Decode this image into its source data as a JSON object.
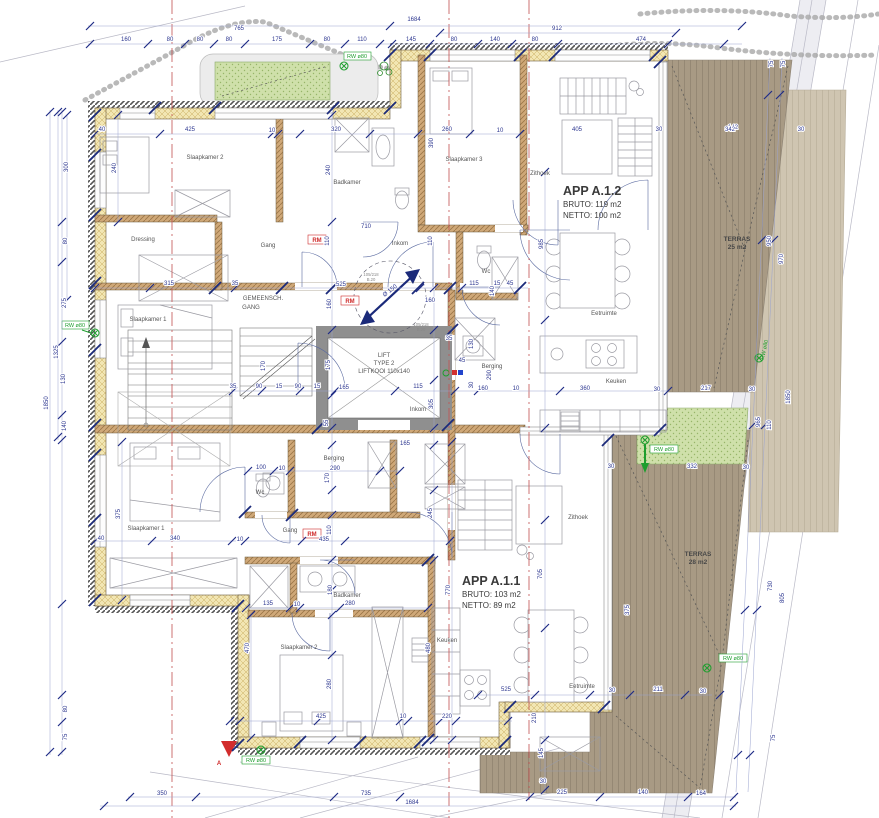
{
  "colors": {
    "dimension_text": "#2d3790",
    "wall_exterior": "#f2e6b3",
    "wall_interior": "#cfa878",
    "terrace_deck": "#a89a84",
    "terrace_light": "#cfc5b1",
    "green_roof": "#cfe0aa",
    "red_mark": "#cf2b2b",
    "green_mark": "#1e9e2e",
    "reference_line": "#c25050"
  },
  "labels": {
    "apartments": [
      {
        "t": "APP A.1.2",
        "x": 563,
        "y": 195,
        "c": "app",
        "a": "start"
      },
      {
        "t": "BRUTO: 119 m2",
        "x": 563,
        "y": 207,
        "c": "appsub",
        "a": "start"
      },
      {
        "t": "NETTO: 100 m2",
        "x": 563,
        "y": 218,
        "c": "appsub",
        "a": "start"
      },
      {
        "t": "APP A.1.1",
        "x": 462,
        "y": 585,
        "c": "app",
        "a": "start"
      },
      {
        "t": "BRUTO: 103 m2",
        "x": 462,
        "y": 597,
        "c": "appsub",
        "a": "start"
      },
      {
        "t": "NETTO: 89 m2",
        "x": 462,
        "y": 608,
        "c": "appsub",
        "a": "start"
      }
    ],
    "terraces": [
      {
        "t": "TERRAS",
        "x": 737,
        "y": 241,
        "c": "ter"
      },
      {
        "t": "25 m2",
        "x": 737,
        "y": 249,
        "c": "ter"
      },
      {
        "t": "TERRAS",
        "x": 698,
        "y": 556,
        "c": "ter"
      },
      {
        "t": "28 m2",
        "x": 698,
        "y": 564,
        "c": "ter"
      }
    ],
    "rooms": [
      {
        "t": "Slaapkamer 2",
        "x": 205,
        "y": 159,
        "c": "room"
      },
      {
        "t": "Badkamer",
        "x": 347,
        "y": 184,
        "c": "room"
      },
      {
        "t": "Slaapkamer 3",
        "x": 464,
        "y": 161,
        "c": "room"
      },
      {
        "t": "Dressing",
        "x": 143,
        "y": 241,
        "c": "room"
      },
      {
        "t": "Gang",
        "x": 268,
        "y": 247,
        "c": "room"
      },
      {
        "t": "Inkom",
        "x": 400,
        "y": 245,
        "c": "room"
      },
      {
        "t": "Zithoek",
        "x": 540,
        "y": 175,
        "c": "room"
      },
      {
        "t": "Slaapkamer 1",
        "x": 148,
        "y": 321,
        "c": "room"
      },
      {
        "t": "GEMEENSCH.",
        "x": 263,
        "y": 300,
        "c": "room"
      },
      {
        "t": "GANG",
        "x": 251,
        "y": 309,
        "c": "room"
      },
      {
        "t": "Wc",
        "x": 486,
        "y": 273,
        "c": "room"
      },
      {
        "t": "Berging",
        "x": 492,
        "y": 368,
        "c": "room"
      },
      {
        "t": "Eetruimte",
        "x": 604,
        "y": 315,
        "c": "room"
      },
      {
        "t": "Keuken",
        "x": 616,
        "y": 383,
        "c": "room"
      },
      {
        "t": "Berging",
        "x": 334,
        "y": 460,
        "c": "room"
      },
      {
        "t": "Wc",
        "x": 260,
        "y": 494,
        "c": "room"
      },
      {
        "t": "Slaapkamer 1",
        "x": 146,
        "y": 530,
        "c": "room"
      },
      {
        "t": "Gang",
        "x": 290,
        "y": 532,
        "c": "room"
      },
      {
        "t": "Inkom",
        "x": 418,
        "y": 411,
        "c": "room"
      },
      {
        "t": "Badkamer",
        "x": 347,
        "y": 597,
        "c": "room"
      },
      {
        "t": "Slaapkamer 2",
        "x": 299,
        "y": 649,
        "c": "room"
      },
      {
        "t": "Keuken",
        "x": 447,
        "y": 642,
        "c": "room"
      },
      {
        "t": "Zithoek",
        "x": 578,
        "y": 519,
        "c": "room"
      },
      {
        "t": "Eetruimte",
        "x": 582,
        "y": 688,
        "c": "room"
      }
    ],
    "lift": [
      {
        "t": "LIFT",
        "x": 384,
        "y": 357,
        "c": "lift"
      },
      {
        "t": "TYPE 2",
        "x": 384,
        "y": 365,
        "c": "lift"
      },
      {
        "t": "LIFTKOOI 110x140",
        "x": 384,
        "y": 373,
        "c": "lift"
      }
    ],
    "red_marks": [
      {
        "t": "RM",
        "x": 317,
        "y": 242,
        "c": "red"
      },
      {
        "t": "RM",
        "x": 350,
        "y": 303,
        "c": "red"
      },
      {
        "t": "RM",
        "x": 312,
        "y": 536,
        "c": "red"
      },
      {
        "t": "A",
        "x": 219,
        "y": 765,
        "c": "red"
      }
    ],
    "green_marks": [
      {
        "t": "RW ø80",
        "x": 357,
        "y": 58,
        "c": "grn"
      },
      {
        "t": "RW ø80",
        "x": 75,
        "y": 327,
        "c": "grn"
      },
      {
        "t": "RW ø80",
        "x": 766,
        "y": 350,
        "c": "grn",
        "r": -78
      },
      {
        "t": "RW ø80",
        "x": 664,
        "y": 451,
        "c": "grn"
      },
      {
        "t": "RW ø80",
        "x": 733,
        "y": 660,
        "c": "grn"
      },
      {
        "t": "RW ø80",
        "x": 256,
        "y": 762,
        "c": "grn"
      }
    ],
    "annotations": [
      {
        "t": "105/218",
        "x": 371,
        "y": 276,
        "c": "tiny"
      },
      {
        "t": "B.20",
        "x": 371,
        "y": 281,
        "c": "tiny"
      },
      {
        "t": "105/218",
        "x": 421,
        "y": 326,
        "c": "tiny"
      },
      {
        "t": "B.20",
        "x": 421,
        "y": 331,
        "c": "tiny"
      },
      {
        "t": "Ø 150",
        "x": 391,
        "y": 292,
        "c": "circ",
        "r": -38
      }
    ],
    "dimensions": [
      {
        "t": "765",
        "x": 239,
        "y": 30,
        "c": "dim"
      },
      {
        "t": "1684",
        "x": 414,
        "y": 21,
        "c": "dim"
      },
      {
        "t": "912",
        "x": 557,
        "y": 30,
        "c": "dim"
      },
      {
        "t": "160",
        "x": 126,
        "y": 41,
        "c": "dim"
      },
      {
        "t": "80",
        "x": 170,
        "y": 41,
        "c": "dim"
      },
      {
        "t": "80",
        "x": 200,
        "y": 41,
        "c": "dim"
      },
      {
        "t": "80",
        "x": 229,
        "y": 41,
        "c": "dim"
      },
      {
        "t": "175",
        "x": 277,
        "y": 41,
        "c": "dim"
      },
      {
        "t": "80",
        "x": 327,
        "y": 41,
        "c": "dim"
      },
      {
        "t": "110",
        "x": 362,
        "y": 41,
        "c": "dim"
      },
      {
        "t": "145",
        "x": 411,
        "y": 41,
        "c": "dim"
      },
      {
        "t": "80",
        "x": 454,
        "y": 41,
        "c": "dim"
      },
      {
        "t": "140",
        "x": 495,
        "y": 41,
        "c": "dim"
      },
      {
        "t": "80",
        "x": 535,
        "y": 41,
        "c": "dim"
      },
      {
        "t": "474",
        "x": 641,
        "y": 41,
        "c": "dim"
      },
      {
        "t": "142",
        "x": 733,
        "y": 129,
        "c": "dim"
      },
      {
        "t": "300",
        "x": 68,
        "y": 167,
        "c": "dim",
        "r": -90
      },
      {
        "t": "80",
        "x": 67,
        "y": 241,
        "c": "dim",
        "r": -90
      },
      {
        "t": "275",
        "x": 66,
        "y": 303,
        "c": "dim",
        "r": -90
      },
      {
        "t": "1325",
        "x": 58,
        "y": 352,
        "c": "dim",
        "r": -90
      },
      {
        "t": "130",
        "x": 65,
        "y": 379,
        "c": "dim",
        "r": -90
      },
      {
        "t": "1850",
        "x": 48,
        "y": 403,
        "c": "dim",
        "r": -90
      },
      {
        "t": "140",
        "x": 66,
        "y": 426,
        "c": "dim",
        "r": -90
      },
      {
        "t": "80",
        "x": 67,
        "y": 709,
        "c": "dim",
        "r": -90
      },
      {
        "t": "75",
        "x": 67,
        "y": 737,
        "c": "dim",
        "r": -90
      },
      {
        "t": "40",
        "x": 102,
        "y": 131,
        "c": "dim"
      },
      {
        "t": "40",
        "x": 101,
        "y": 540,
        "c": "dim"
      },
      {
        "t": "375",
        "x": 120,
        "y": 514,
        "c": "dim",
        "r": -90
      },
      {
        "t": "350",
        "x": 162,
        "y": 795,
        "c": "dim"
      },
      {
        "t": "735",
        "x": 366,
        "y": 795,
        "c": "dim"
      },
      {
        "t": "1684",
        "x": 412,
        "y": 804,
        "c": "dim"
      },
      {
        "t": "225",
        "x": 562,
        "y": 794,
        "c": "dim"
      },
      {
        "t": "140",
        "x": 643,
        "y": 794,
        "c": "dim"
      },
      {
        "t": "164",
        "x": 701,
        "y": 795,
        "c": "dim"
      },
      {
        "t": "525",
        "x": 506,
        "y": 691,
        "c": "dim"
      },
      {
        "t": "30",
        "x": 612,
        "y": 692,
        "c": "dim"
      },
      {
        "t": "211",
        "x": 658,
        "y": 691,
        "c": "dim"
      },
      {
        "t": "30",
        "x": 703,
        "y": 693,
        "c": "dim"
      },
      {
        "t": "220",
        "x": 447,
        "y": 718,
        "c": "dim"
      },
      {
        "t": "425",
        "x": 321,
        "y": 718,
        "c": "dim"
      },
      {
        "t": "10",
        "x": 403,
        "y": 718,
        "c": "dim"
      },
      {
        "t": "210",
        "x": 536,
        "y": 718,
        "c": "dim",
        "r": -90
      },
      {
        "t": "145",
        "x": 543,
        "y": 753,
        "c": "dim",
        "r": -90
      },
      {
        "t": "30",
        "x": 543,
        "y": 783,
        "c": "dim"
      },
      {
        "t": "75",
        "x": 775,
        "y": 738,
        "c": "dim",
        "r": -90
      },
      {
        "t": "30",
        "x": 659,
        "y": 131,
        "c": "dim"
      },
      {
        "t": "342",
        "x": 730,
        "y": 131,
        "c": "dim"
      },
      {
        "t": "30",
        "x": 801,
        "y": 131,
        "c": "dim"
      },
      {
        "t": "75",
        "x": 773,
        "y": 64,
        "c": "dim",
        "r": -90
      },
      {
        "t": "75",
        "x": 785,
        "y": 64,
        "c": "dim",
        "r": -90
      },
      {
        "t": "950",
        "x": 771,
        "y": 241,
        "c": "dim",
        "r": -90
      },
      {
        "t": "970",
        "x": 783,
        "y": 259,
        "c": "dim",
        "r": -90
      },
      {
        "t": "1850",
        "x": 790,
        "y": 397,
        "c": "dim",
        "r": -90
      },
      {
        "t": "110",
        "x": 771,
        "y": 425,
        "c": "dim",
        "r": -90
      },
      {
        "t": "965",
        "x": 760,
        "y": 422,
        "c": "dim",
        "r": -90
      },
      {
        "t": "30",
        "x": 752,
        "y": 391,
        "c": "dim"
      },
      {
        "t": "217",
        "x": 706,
        "y": 390,
        "c": "dim"
      },
      {
        "t": "30",
        "x": 657,
        "y": 391,
        "c": "dim"
      },
      {
        "t": "360",
        "x": 585,
        "y": 390,
        "c": "dim"
      },
      {
        "t": "332",
        "x": 692,
        "y": 468,
        "c": "dim"
      },
      {
        "t": "30",
        "x": 611,
        "y": 468,
        "c": "dim"
      },
      {
        "t": "30",
        "x": 746,
        "y": 469,
        "c": "dim"
      },
      {
        "t": "730",
        "x": 772,
        "y": 586,
        "c": "dim",
        "r": -90
      },
      {
        "t": "805",
        "x": 784,
        "y": 598,
        "c": "dim",
        "r": -90
      },
      {
        "t": "375",
        "x": 629,
        "y": 610,
        "c": "dim",
        "r": -90
      },
      {
        "t": "425",
        "x": 190,
        "y": 131,
        "c": "dim"
      },
      {
        "t": "10",
        "x": 272,
        "y": 132,
        "c": "dim"
      },
      {
        "t": "320",
        "x": 336,
        "y": 131,
        "c": "dim"
      },
      {
        "t": "260",
        "x": 447,
        "y": 131,
        "c": "dim"
      },
      {
        "t": "10",
        "x": 500,
        "y": 132,
        "c": "dim"
      },
      {
        "t": "240",
        "x": 116,
        "y": 168,
        "c": "dim",
        "r": -90
      },
      {
        "t": "240",
        "x": 330,
        "y": 170,
        "c": "dim",
        "r": -90
      },
      {
        "t": "390",
        "x": 433,
        "y": 143,
        "c": "dim",
        "r": -90
      },
      {
        "t": "405",
        "x": 577,
        "y": 131,
        "c": "dim"
      },
      {
        "t": "985",
        "x": 543,
        "y": 244,
        "c": "dim",
        "r": -90
      },
      {
        "t": "710",
        "x": 366,
        "y": 228,
        "c": "dim"
      },
      {
        "t": "315",
        "x": 169,
        "y": 285,
        "c": "dim"
      },
      {
        "t": "35",
        "x": 235,
        "y": 285,
        "c": "dim"
      },
      {
        "t": "525",
        "x": 341,
        "y": 286,
        "c": "dim"
      },
      {
        "t": "110",
        "x": 329,
        "y": 241,
        "c": "dim",
        "r": -90
      },
      {
        "t": "110",
        "x": 432,
        "y": 241,
        "c": "dim",
        "r": -90
      },
      {
        "t": "115",
        "x": 474,
        "y": 285,
        "c": "dim"
      },
      {
        "t": "15",
        "x": 497,
        "y": 285,
        "c": "dim"
      },
      {
        "t": "45",
        "x": 510,
        "y": 285,
        "c": "dim"
      },
      {
        "t": "140",
        "x": 494,
        "y": 291,
        "c": "dim",
        "r": -90
      },
      {
        "t": "160",
        "x": 331,
        "y": 304,
        "c": "dim",
        "r": -90
      },
      {
        "t": "160",
        "x": 430,
        "y": 302,
        "c": "dim"
      },
      {
        "t": "170",
        "x": 265,
        "y": 366,
        "c": "dim",
        "r": -90
      },
      {
        "t": "175",
        "x": 330,
        "y": 365,
        "c": "dim",
        "r": -90
      },
      {
        "t": "165",
        "x": 344,
        "y": 389,
        "c": "dim"
      },
      {
        "t": "115",
        "x": 418,
        "y": 388,
        "c": "dim"
      },
      {
        "t": "90",
        "x": 259,
        "y": 388,
        "c": "dim"
      },
      {
        "t": "15",
        "x": 279,
        "y": 388,
        "c": "dim"
      },
      {
        "t": "90",
        "x": 298,
        "y": 388,
        "c": "dim"
      },
      {
        "t": "15",
        "x": 317,
        "y": 388,
        "c": "dim"
      },
      {
        "t": "35",
        "x": 233,
        "y": 388,
        "c": "dim"
      },
      {
        "t": "35",
        "x": 449,
        "y": 340,
        "c": "dim"
      },
      {
        "t": "55",
        "x": 328,
        "y": 423,
        "c": "dim",
        "r": -90
      },
      {
        "t": "305",
        "x": 433,
        "y": 404,
        "c": "dim",
        "r": -90
      },
      {
        "t": "130",
        "x": 473,
        "y": 344,
        "c": "dim",
        "r": -90
      },
      {
        "t": "45",
        "x": 462,
        "y": 362,
        "c": "dim"
      },
      {
        "t": "290",
        "x": 491,
        "y": 375,
        "c": "dim",
        "r": -90
      },
      {
        "t": "30",
        "x": 473,
        "y": 385,
        "c": "dim",
        "r": -90
      },
      {
        "t": "160",
        "x": 483,
        "y": 390,
        "c": "dim"
      },
      {
        "t": "10",
        "x": 516,
        "y": 390,
        "c": "dim"
      },
      {
        "t": "165",
        "x": 405,
        "y": 445,
        "c": "dim"
      },
      {
        "t": "100",
        "x": 261,
        "y": 469,
        "c": "dim"
      },
      {
        "t": "10",
        "x": 282,
        "y": 470,
        "c": "dim"
      },
      {
        "t": "290",
        "x": 335,
        "y": 470,
        "c": "dim"
      },
      {
        "t": "170",
        "x": 329,
        "y": 478,
        "c": "dim",
        "r": -90
      },
      {
        "t": "110",
        "x": 331,
        "y": 530,
        "c": "dim",
        "r": -90
      },
      {
        "t": "435",
        "x": 324,
        "y": 541,
        "c": "dim"
      },
      {
        "t": "180",
        "x": 332,
        "y": 590,
        "c": "dim",
        "r": -90
      },
      {
        "t": "245",
        "x": 432,
        "y": 513,
        "c": "dim",
        "r": -90
      },
      {
        "t": "770",
        "x": 450,
        "y": 590,
        "c": "dim",
        "r": -90
      },
      {
        "t": "705",
        "x": 542,
        "y": 574,
        "c": "dim",
        "r": -90
      },
      {
        "t": "340",
        "x": 175,
        "y": 540,
        "c": "dim"
      },
      {
        "t": "10",
        "x": 240,
        "y": 541,
        "c": "dim"
      },
      {
        "t": "135",
        "x": 268,
        "y": 605,
        "c": "dim"
      },
      {
        "t": "10",
        "x": 297,
        "y": 606,
        "c": "dim"
      },
      {
        "t": "280",
        "x": 350,
        "y": 605,
        "c": "dim"
      },
      {
        "t": "470",
        "x": 249,
        "y": 648,
        "c": "dim",
        "r": -90
      },
      {
        "t": "280",
        "x": 331,
        "y": 684,
        "c": "dim",
        "r": -90
      },
      {
        "t": "480",
        "x": 430,
        "y": 648,
        "c": "dim",
        "r": -90
      }
    ]
  }
}
